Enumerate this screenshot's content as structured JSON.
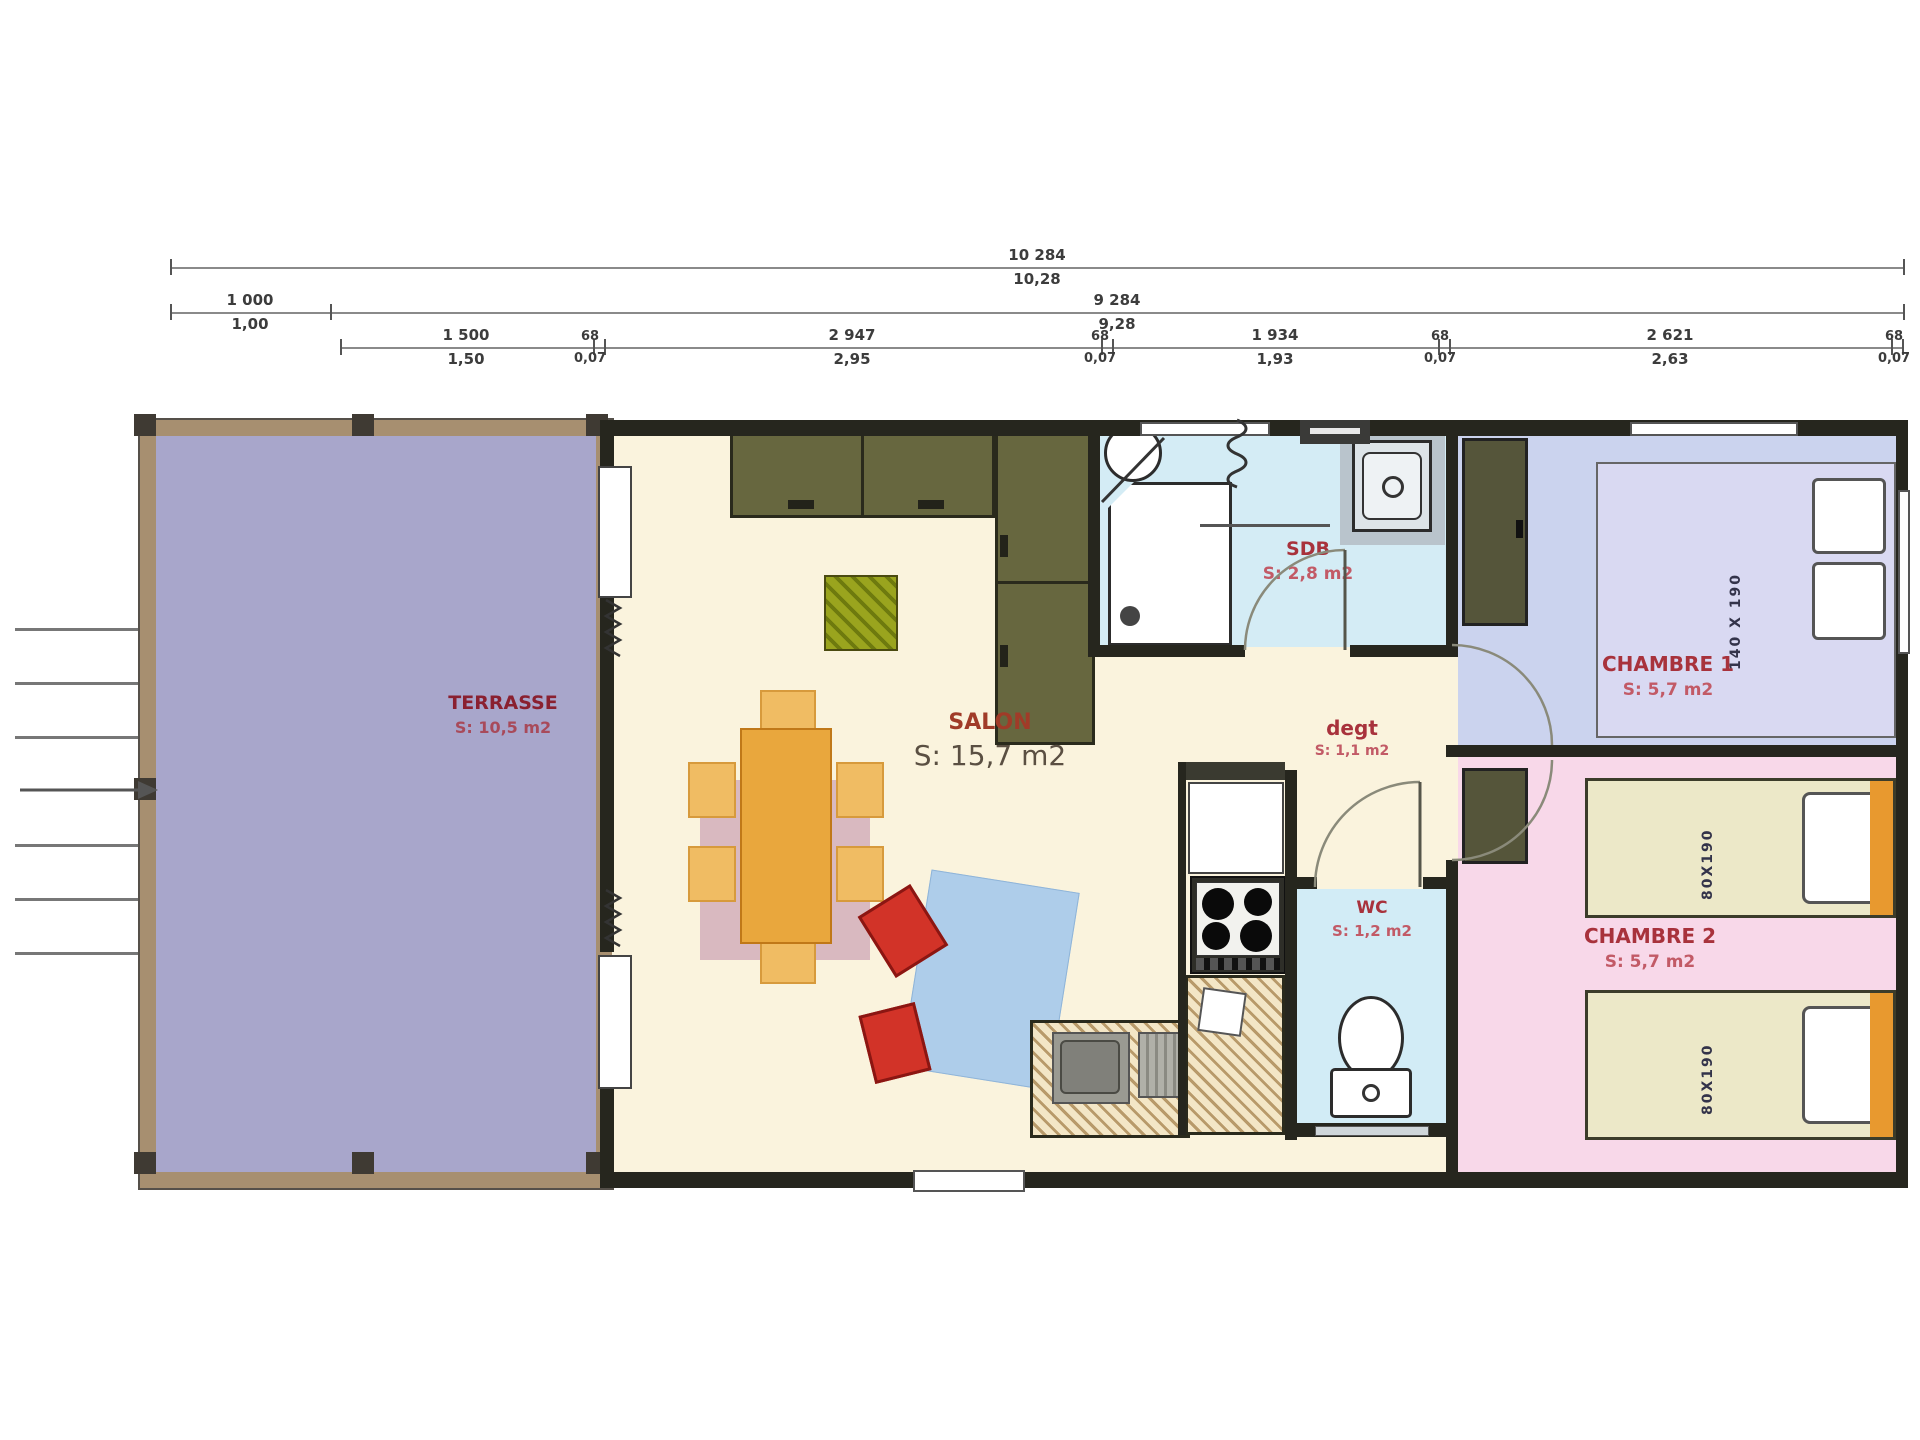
{
  "dims": {
    "total": {
      "mm": "10 284",
      "m": "10,28"
    },
    "row2": [
      {
        "mm": "1 000",
        "m": "1,00"
      },
      {
        "mm": "9 284",
        "m": "9,28"
      }
    ],
    "row3": [
      {
        "mm": "1 500",
        "m": "1,50"
      },
      {
        "mm": "68",
        "m": "0,07"
      },
      {
        "mm": "2 947",
        "m": "2,95"
      },
      {
        "mm": "68",
        "m": "0,07"
      },
      {
        "mm": "1 934",
        "m": "1,93"
      },
      {
        "mm": "68",
        "m": "0,07"
      },
      {
        "mm": "2 621",
        "m": "2,63"
      },
      {
        "mm": "68",
        "m": "0,07"
      }
    ]
  },
  "rooms": {
    "terrasse": {
      "name": "TERRASSE",
      "area": "S: 10,5 m2"
    },
    "salon": {
      "name": "SALON",
      "area": "S: 15,7 m2"
    },
    "sdb": {
      "name": "SDB",
      "area": "S: 2,8 m2"
    },
    "degt": {
      "name": "degt",
      "area": "S: 1,1 m2"
    },
    "wc": {
      "name": "WC",
      "area": "S: 1,2 m2"
    },
    "chambre1": {
      "name": "CHAMBRE 1",
      "area": "S: 5,7 m2",
      "bed": "140 X 190"
    },
    "chambre2": {
      "name": "CHAMBRE 2",
      "area": "S: 5,7 m2",
      "bed1": "80X190",
      "bed2": "80X190"
    }
  },
  "colors": {
    "wall": "#26261e",
    "terrace_floor": "#a8a6cb",
    "terrace_frame": "#a78f70",
    "interior_floor": "#faf3dd",
    "wet_room_floor": "#d4ecf5",
    "chambre1_floor": "#cbd3ee",
    "chambre2_floor": "#f8d8e9",
    "cabinet_olive": "#67673f",
    "table_orange": "#e9a73d",
    "sofa_blue": "#aecdea",
    "chair_red": "#d23328",
    "label_red": "#a8323c"
  }
}
